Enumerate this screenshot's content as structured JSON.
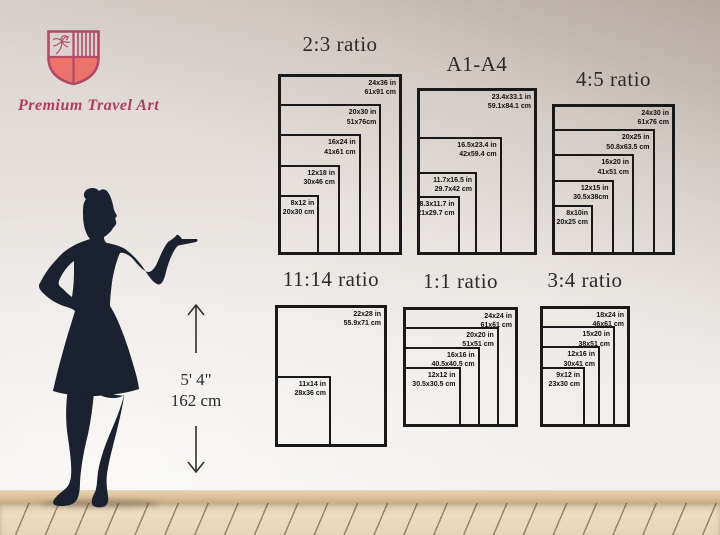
{
  "brand": {
    "name": "Premium Travel Art",
    "colors": {
      "outline_pink": "#b14a68",
      "shield_coral": "#ed7269",
      "text_pink": "#b23b60"
    }
  },
  "height_marker": {
    "line1": "5' 4\"",
    "line2": "162 cm"
  },
  "silhouette_color": "#19222e",
  "panels": [
    {
      "title": "2:3 ratio",
      "sizes": [
        {
          "w": 24,
          "h": 36,
          "in": "24x36 in",
          "cm": "61x91 cm"
        },
        {
          "w": 20,
          "h": 30,
          "in": "20x30 in",
          "cm": "51x76cm"
        },
        {
          "w": 16,
          "h": 24,
          "in": "16x24 in",
          "cm": "41x61 cm"
        },
        {
          "w": 12,
          "h": 18,
          "in": "12x18 in",
          "cm": "30x46 cm"
        },
        {
          "w": 8,
          "h": 12,
          "in": "8x12 in",
          "cm": "20x30 cm"
        }
      ]
    },
    {
      "title": "A1-A4",
      "sizes": [
        {
          "w": 23.4,
          "h": 33.1,
          "in": "23.4x33.1 in",
          "cm": "59.1x84.1 cm"
        },
        {
          "w": 16.5,
          "h": 23.4,
          "in": "16.5x23.4 in",
          "cm": "42x59.4 cm"
        },
        {
          "w": 11.7,
          "h": 16.5,
          "in": "11.7x16.5 in",
          "cm": "29.7x42 cm"
        },
        {
          "w": 8.3,
          "h": 11.7,
          "in": "8.3x11.7 in",
          "cm": "21x29.7 cm"
        }
      ]
    },
    {
      "title": "4:5 ratio",
      "sizes": [
        {
          "w": 24,
          "h": 30,
          "in": "24x30 in",
          "cm": "61x76 cm"
        },
        {
          "w": 20,
          "h": 25,
          "in": "20x25 in",
          "cm": "50.8x63.5 cm"
        },
        {
          "w": 16,
          "h": 20,
          "in": "16x20 in",
          "cm": "41x51 cm"
        },
        {
          "w": 12,
          "h": 15,
          "in": "12x15 in",
          "cm": "30.5x38cm"
        },
        {
          "w": 8,
          "h": 10,
          "in": "8x10in",
          "cm": "20x25 cm"
        }
      ]
    },
    {
      "title": "11:14 ratio",
      "sizes": [
        {
          "w": 22,
          "h": 28,
          "in": "22x28 in",
          "cm": "55.9x71 cm"
        },
        {
          "w": 11,
          "h": 14,
          "in": "11x14 in",
          "cm": "28x36 cm"
        }
      ]
    },
    {
      "title": "1:1 ratio",
      "sizes": [
        {
          "w": 24,
          "h": 24,
          "in": "24x24 in",
          "cm": "61x61 cm"
        },
        {
          "w": 20,
          "h": 20,
          "in": "20x20 in",
          "cm": "51x51 cm"
        },
        {
          "w": 16,
          "h": 16,
          "in": "16x16 in",
          "cm": "40.5x40.5 cm"
        },
        {
          "w": 12,
          "h": 12,
          "in": "12x12 in",
          "cm": "30.5x30.5 cm"
        }
      ]
    },
    {
      "title": "3:4 ratio",
      "sizes": [
        {
          "w": 18,
          "h": 24,
          "in": "18x24 in",
          "cm": "46x61 cm"
        },
        {
          "w": 15,
          "h": 20,
          "in": "15x20 in",
          "cm": "38x51 cm"
        },
        {
          "w": 12,
          "h": 16,
          "in": "12x16 in",
          "cm": "30x41 cm"
        },
        {
          "w": 9,
          "h": 12,
          "in": "9x12 in",
          "cm": "23x30 cm"
        }
      ]
    }
  ]
}
